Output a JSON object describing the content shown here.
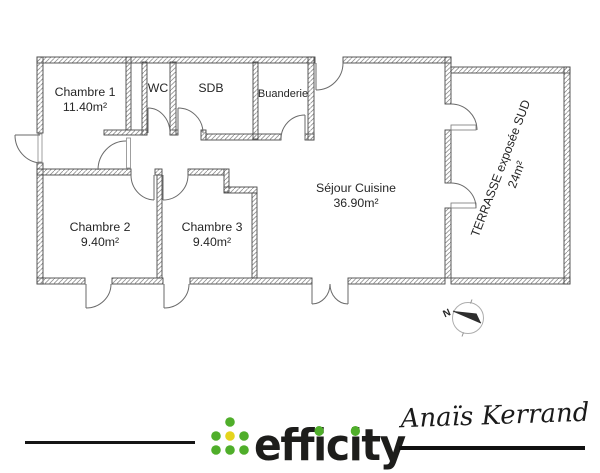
{
  "plan": {
    "rooms": [
      {
        "name": "Chambre 1",
        "area": "11.40m²"
      },
      {
        "name": "WC",
        "area": ""
      },
      {
        "name": "SDB",
        "area": ""
      },
      {
        "name": "Buanderie",
        "area": ""
      },
      {
        "name": "Séjour Cuisine",
        "area": "36.90m²"
      },
      {
        "name": "Chambre 2",
        "area": "9.40m²"
      },
      {
        "name": "Chambre 3",
        "area": "9.40m²"
      },
      {
        "name": "TERRASSE exposée SUD",
        "area": "24m²"
      }
    ],
    "compass": {
      "north_label": "N"
    }
  },
  "footer": {
    "brand": {
      "name": "efficity",
      "part_eff": "eff",
      "part_i1": "i",
      "part_c": "c",
      "part_i2": "i",
      "part_ty": "ty",
      "dot_green": "#4FAE2A",
      "dot_yellow": "#E5D41C",
      "text_color": "#1D1D1B"
    },
    "signature": {
      "name": "Anaïs Kerrand",
      "ink_color": "#1a1a1a"
    }
  }
}
